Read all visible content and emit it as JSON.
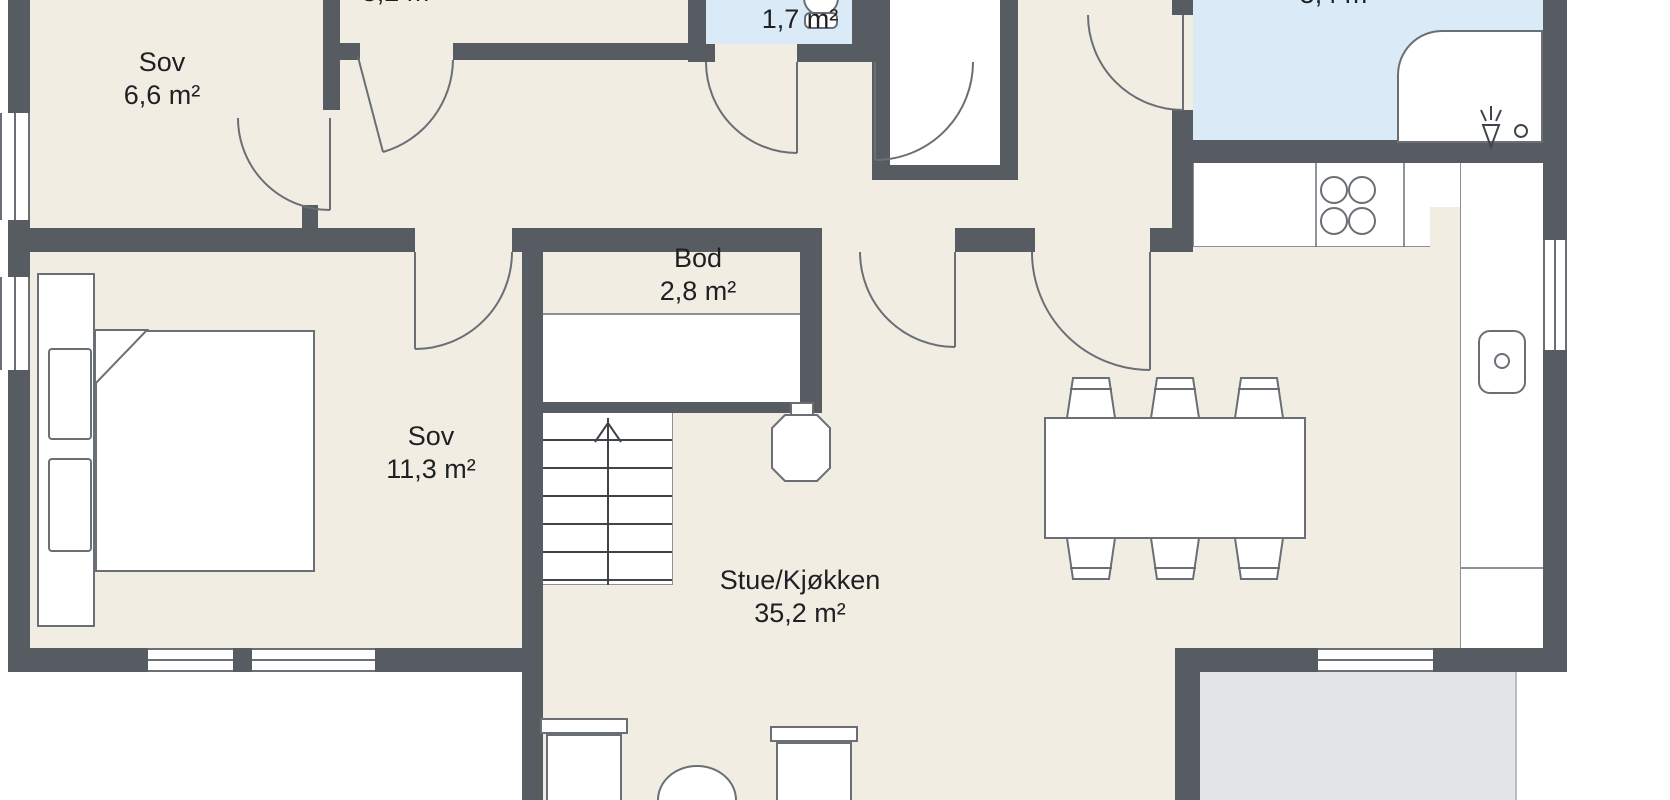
{
  "rooms": {
    "sov1": {
      "name": "Sov",
      "area": "6,6 m²"
    },
    "sov2": {
      "name": "Sov",
      "area": "11,3 m²"
    },
    "bod": {
      "name": "Bod",
      "area": "2,8 m²"
    },
    "wc": {
      "name": "",
      "area": "1,7 m²"
    },
    "stue": {
      "name": "Stue/Kjøkken",
      "area": "35,2 m²"
    },
    "top_partial": {
      "name": "",
      "area": "3,2 m²"
    },
    "bath_partial": {
      "name": "",
      "area": "5,4 m²"
    }
  },
  "colors": {
    "wall": "#575c63",
    "floor": "#f1ede2",
    "water_room": "#daebf7",
    "terrace": "#e3e4e7",
    "outline": "#6a6f75",
    "thin_line": "#8d9197",
    "outside": "#ffffff",
    "furniture_fill": "#ffffff",
    "text": "#1f2023"
  }
}
